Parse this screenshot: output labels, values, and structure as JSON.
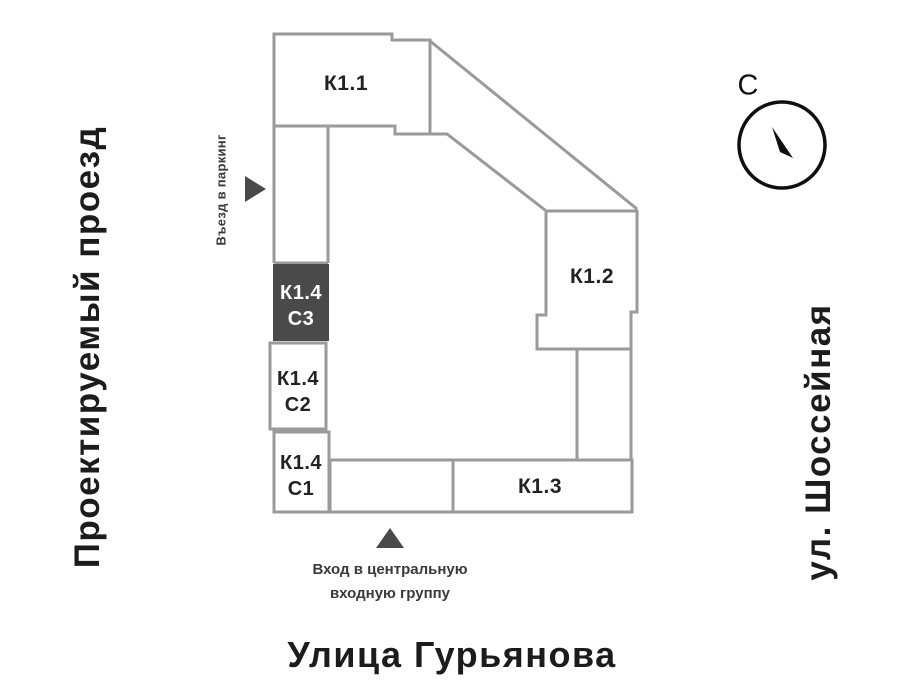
{
  "streets": {
    "left": "Проектируемый проезд",
    "right": "ул. Шоссейная",
    "bottom": "Улица Гурьянова"
  },
  "compass": {
    "north": "С"
  },
  "buildings": {
    "k11": "К1.1",
    "k12": "К1.2",
    "k13": "К1.3",
    "k14": {
      "c3": {
        "line1": "К1.4",
        "line2": "С3"
      },
      "c2": {
        "line1": "К1.4",
        "line2": "С2"
      },
      "c1": {
        "line1": "К1.4",
        "line2": "С1"
      }
    }
  },
  "annotations": {
    "parking": "Въезд в паркинг",
    "entrance": "Вход в центральную входную группу"
  },
  "colors": {
    "outline": "#9a9a9a",
    "highlight_fill": "#4a4a4a",
    "ink": "#222222",
    "compass_ink": "#0f0f0f"
  }
}
